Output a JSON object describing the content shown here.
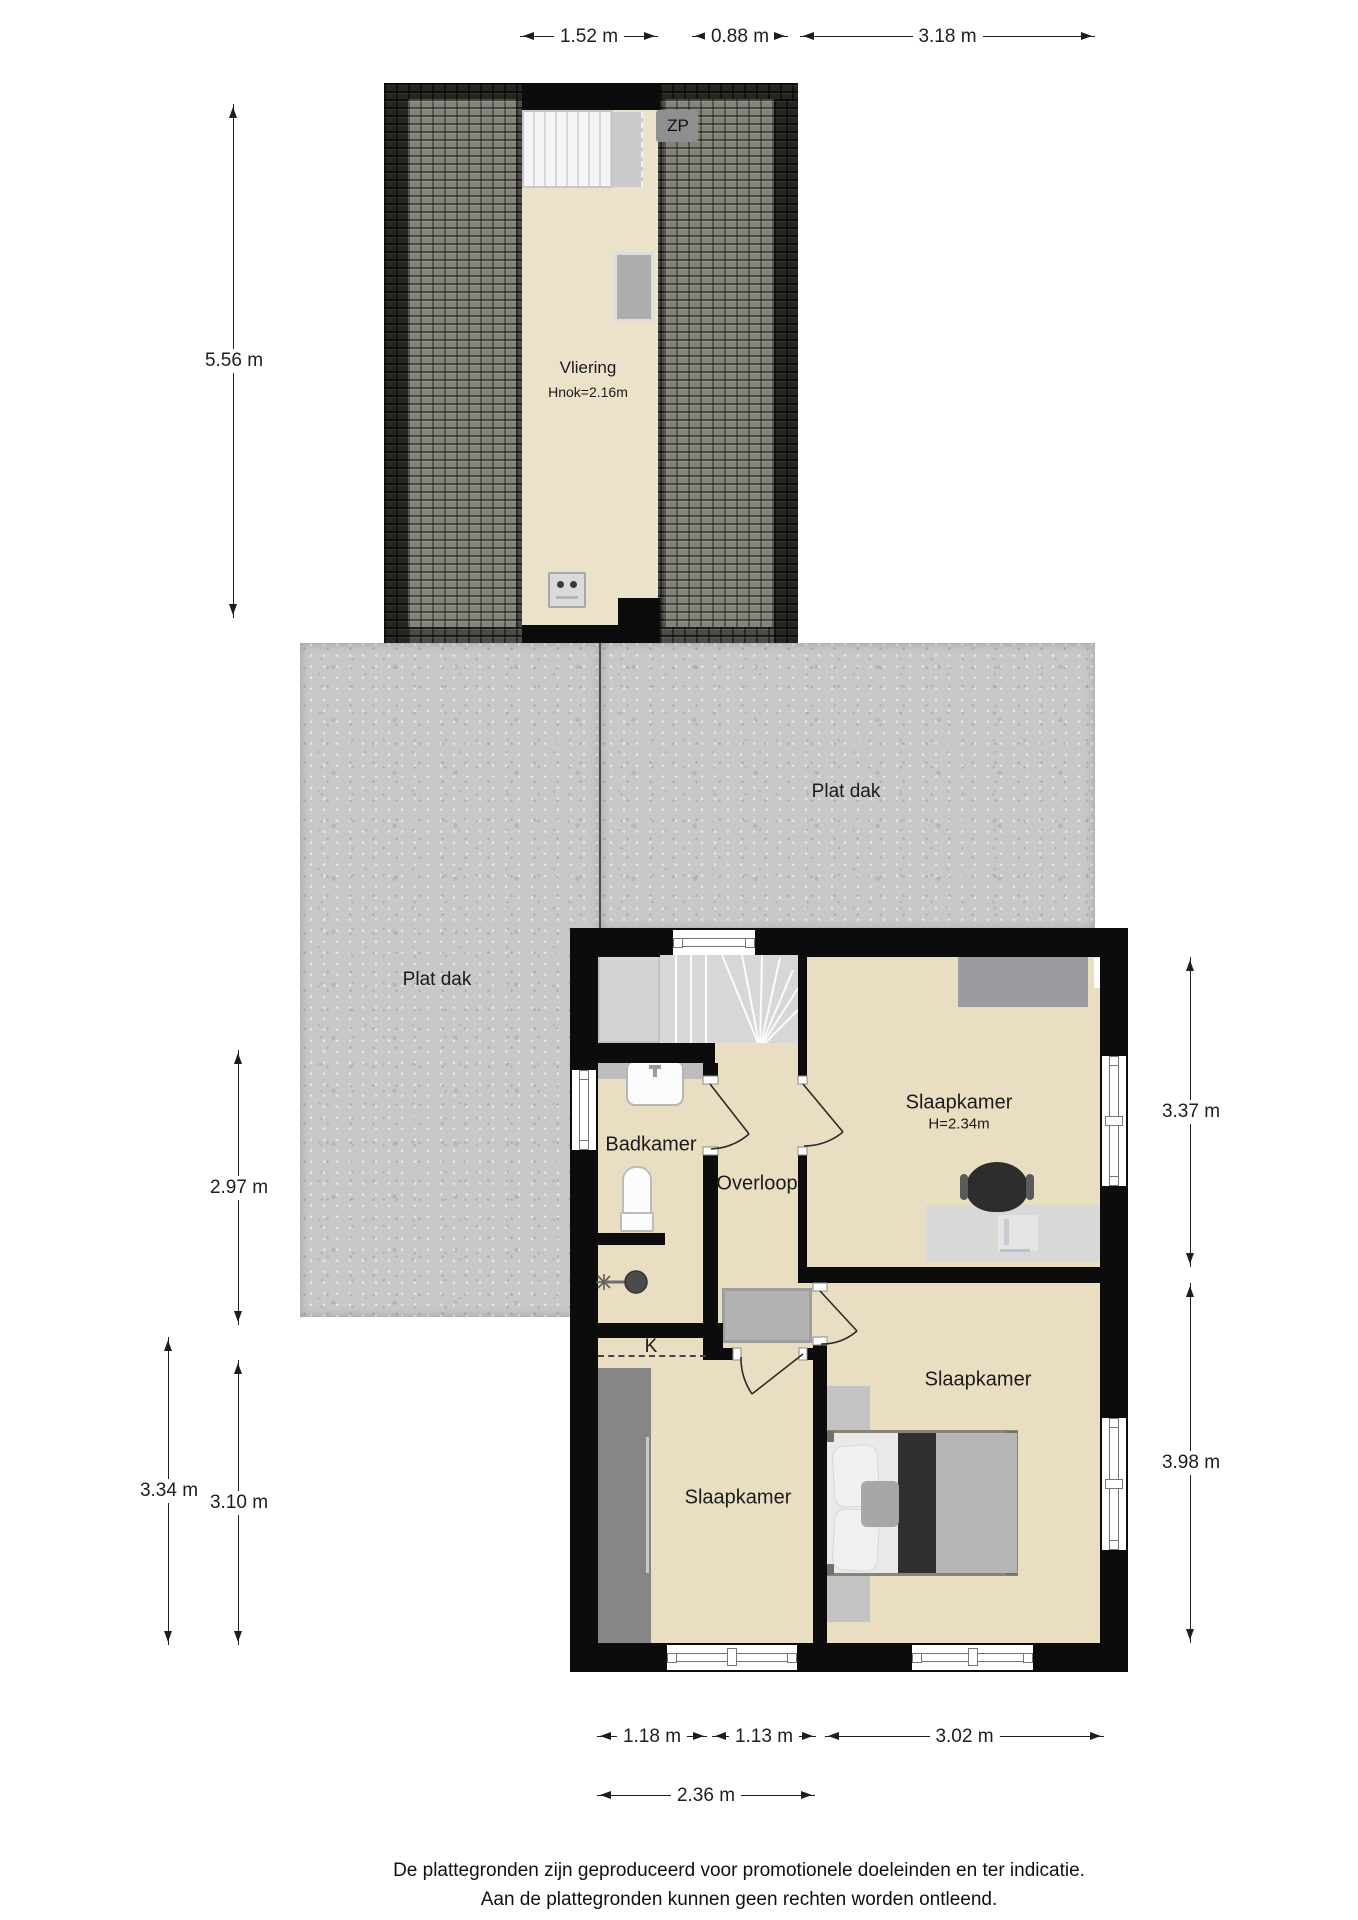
{
  "attic": {
    "name": "Vliering",
    "height_note": "Hnok=2.16m",
    "zp": "ZP"
  },
  "roof": {
    "flat_left": "Plat dak",
    "flat_right": "Plat dak"
  },
  "rooms": {
    "bathroom": "Badkamer",
    "landing": "Overloop",
    "bedroom_top": "Slaapkamer",
    "bedroom_top_height": "H=2.34m",
    "bedroom_left": "Slaapkamer",
    "bedroom_right": "Slaapkamer",
    "closet": "K"
  },
  "dimensions": {
    "top": [
      "1.52 m",
      "0.88 m",
      "3.18 m"
    ],
    "left_attic": "5.56 m",
    "left": [
      "2.97 m",
      "3.34 m",
      "3.10 m"
    ],
    "right": [
      "3.37 m",
      "3.98 m"
    ],
    "bottom": [
      "1.18 m",
      "1.13 m",
      "3.02 m"
    ],
    "bottom2": "2.36 m"
  },
  "footer": {
    "line1": "De plattegronden zijn geproduceerd voor promotionele doeleinden en ter indicatie.",
    "line2": "Aan de plattegronden kunnen geen rechten worden ontleend."
  },
  "colors": {
    "wall": "#0c0c0c",
    "floor": "#e9ddc2",
    "attic_floor": "#ece2c9",
    "concrete": "#c8c8c8",
    "roof_dark": "#26251f",
    "roof_mid": "#4c4b46",
    "roof_light": "#85847b",
    "dimension_text": "#1d1d1d"
  }
}
